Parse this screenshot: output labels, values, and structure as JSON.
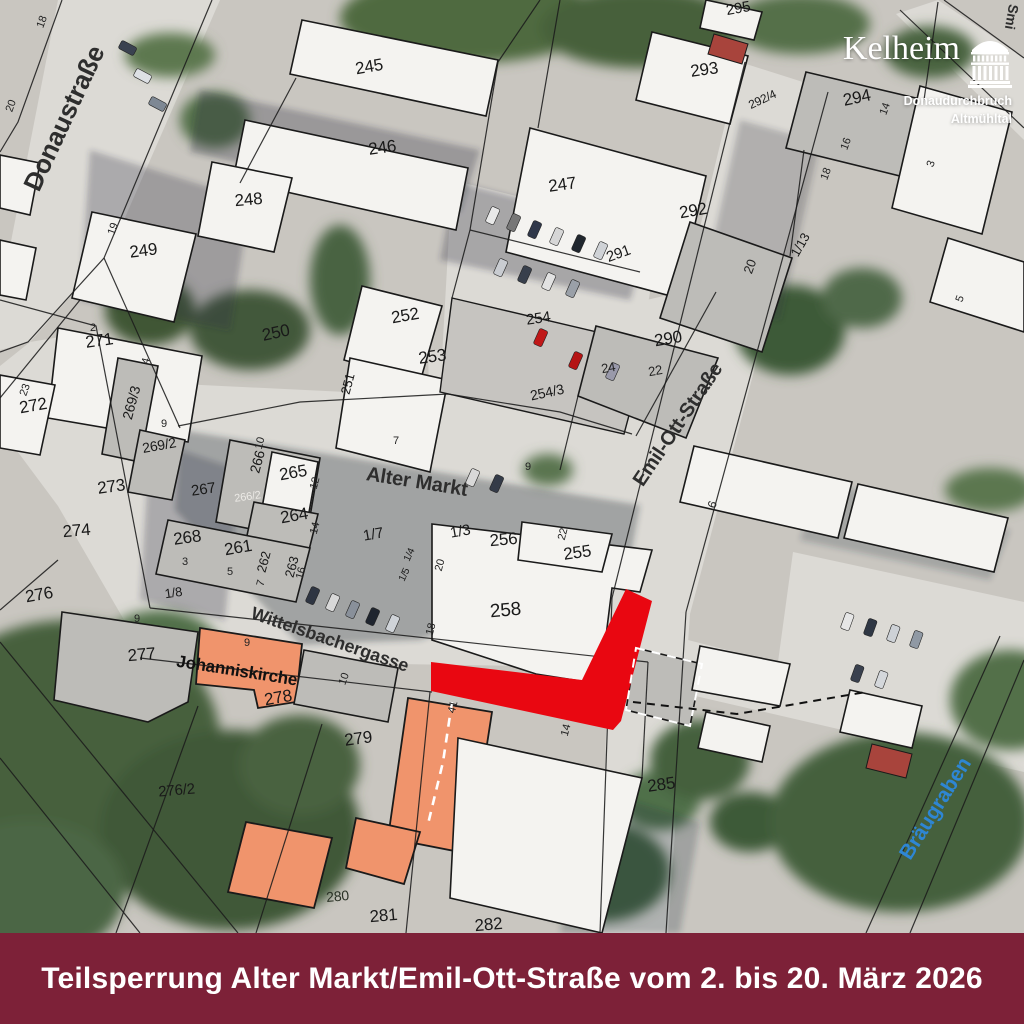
{
  "banner": {
    "text": "Teilsperrung Alter Markt/Emil-Ott-Straße vom 2. bis 20. März 2026",
    "bg_color": "#7d2138",
    "text_color": "#ffffff"
  },
  "logo": {
    "title": "Kelheim",
    "line1": "Donaudurchbruch",
    "line2": "Altmühltal",
    "icon": "befreiungshalle-monument-icon",
    "color": "#ffffff"
  },
  "map": {
    "colors": {
      "closure_red": "#e90711",
      "church_orange": "#f0946c",
      "water_blue": "#2e86d4",
      "building_white": "#f4f3f0",
      "building_gray": "#bdbcb8"
    },
    "label_groups": [
      {
        "name": "street-label",
        "fill": "#2e2e2e",
        "weight": "bold",
        "size": 19,
        "items": [
          {
            "text": "Donaustraße",
            "x": 72,
            "y": 122,
            "rot": -65,
            "size": 26
          },
          {
            "text": "Alter Markt",
            "x": 416,
            "y": 488,
            "rot": 9,
            "size": 20
          },
          {
            "text": "Emil-Ott-Straße",
            "x": 683,
            "y": 428,
            "rot": -56,
            "size": 20
          },
          {
            "text": "Wittelsbachergasse",
            "x": 328,
            "y": 645,
            "rot": 19,
            "size": 18
          },
          {
            "text": "Smi",
            "x": 1007,
            "y": 16,
            "rot": 100,
            "size": 14
          }
        ]
      },
      {
        "name": "water-label",
        "fill": "#2e86d4",
        "weight": "bold",
        "size": 21,
        "items": [
          {
            "text": "Bräugraben",
            "x": 941,
            "y": 812,
            "rot": -58
          }
        ]
      },
      {
        "name": "place-label",
        "fill": "#111111",
        "weight": "bold",
        "size": 17,
        "items": [
          {
            "text": "Johanniskirche",
            "x": 236,
            "y": 676,
            "rot": 9
          }
        ]
      },
      {
        "name": "parcel-label",
        "fill": "#191919",
        "weight": "normal",
        "size": 17,
        "items": [
          {
            "text": "245",
            "x": 370,
            "y": 72,
            "rot": -10
          },
          {
            "text": "246",
            "x": 383,
            "y": 153,
            "rot": -8
          },
          {
            "text": "247",
            "x": 563,
            "y": 190,
            "rot": -8
          },
          {
            "text": "248",
            "x": 249,
            "y": 205,
            "rot": -5
          },
          {
            "text": "249",
            "x": 144,
            "y": 256,
            "rot": -7
          },
          {
            "text": "250",
            "x": 277,
            "y": 338,
            "rot": -12
          },
          {
            "text": "251",
            "x": 352,
            "y": 385,
            "rot": -75,
            "size": 13
          },
          {
            "text": "252",
            "x": 406,
            "y": 321,
            "rot": -10
          },
          {
            "text": "253",
            "x": 433,
            "y": 362,
            "rot": -8
          },
          {
            "text": "254",
            "x": 539,
            "y": 323,
            "rot": -8,
            "size": 15
          },
          {
            "text": "254/3",
            "x": 548,
            "y": 397,
            "rot": -12,
            "size": 14
          },
          {
            "text": "255",
            "x": 578,
            "y": 558,
            "rot": -8
          },
          {
            "text": "256",
            "x": 504,
            "y": 545,
            "rot": -5
          },
          {
            "text": "258",
            "x": 506,
            "y": 616,
            "rot": -5,
            "size": 19
          },
          {
            "text": "290",
            "x": 669,
            "y": 344,
            "rot": -10
          },
          {
            "text": "291",
            "x": 620,
            "y": 258,
            "rot": -20,
            "size": 15
          },
          {
            "text": "292",
            "x": 694,
            "y": 216,
            "rot": -10
          },
          {
            "text": "292/4",
            "x": 764,
            "y": 103,
            "rot": -25,
            "size": 12
          },
          {
            "text": "293",
            "x": 705,
            "y": 75,
            "rot": -8
          },
          {
            "text": "294",
            "x": 858,
            "y": 103,
            "rot": -12
          },
          {
            "text": "295",
            "x": 739,
            "y": 13,
            "rot": -10,
            "size": 15
          },
          {
            "text": "271",
            "x": 100,
            "y": 346,
            "rot": -8
          },
          {
            "text": "272",
            "x": 34,
            "y": 411,
            "rot": -10
          },
          {
            "text": "269/3",
            "x": 136,
            "y": 404,
            "rot": -75,
            "size": 14
          },
          {
            "text": "269/2",
            "x": 160,
            "y": 450,
            "rot": -10,
            "size": 14
          },
          {
            "text": "267",
            "x": 204,
            "y": 494,
            "rot": -8,
            "size": 15
          },
          {
            "text": "266",
            "x": 262,
            "y": 463,
            "rot": -75,
            "size": 14
          },
          {
            "text": "266/2",
            "x": 248,
            "y": 500,
            "rot": -8,
            "size": 11,
            "fill": "#eceae6"
          },
          {
            "text": "265",
            "x": 294,
            "y": 478,
            "rot": -10
          },
          {
            "text": "264",
            "x": 295,
            "y": 521,
            "rot": -10
          },
          {
            "text": "268",
            "x": 188,
            "y": 543,
            "rot": -8
          },
          {
            "text": "261",
            "x": 239,
            "y": 553,
            "rot": -10
          },
          {
            "text": "262",
            "x": 268,
            "y": 563,
            "rot": -75,
            "size": 13
          },
          {
            "text": "263",
            "x": 296,
            "y": 568,
            "rot": -75,
            "size": 13
          },
          {
            "text": "273",
            "x": 112,
            "y": 492,
            "rot": -8
          },
          {
            "text": "274",
            "x": 77,
            "y": 536,
            "rot": -5
          },
          {
            "text": "276",
            "x": 40,
            "y": 600,
            "rot": -10
          },
          {
            "text": "276/2",
            "x": 177,
            "y": 795,
            "rot": -5,
            "size": 15
          },
          {
            "text": "277",
            "x": 142,
            "y": 660,
            "rot": -5
          },
          {
            "text": "278",
            "x": 279,
            "y": 703,
            "rot": -10
          },
          {
            "text": "279",
            "x": 359,
            "y": 744,
            "rot": -8
          },
          {
            "text": "280",
            "x": 338,
            "y": 901,
            "rot": -5,
            "size": 14,
            "fill": "#2a3226"
          },
          {
            "text": "281",
            "x": 384,
            "y": 921,
            "rot": -5
          },
          {
            "text": "282",
            "x": 489,
            "y": 930,
            "rot": -5
          },
          {
            "text": "285",
            "x": 662,
            "y": 790,
            "rot": -8
          },
          {
            "text": "1/7",
            "x": 374,
            "y": 539,
            "rot": -10,
            "size": 15
          },
          {
            "text": "1/3",
            "x": 461,
            "y": 536,
            "rot": -10,
            "size": 15
          },
          {
            "text": "1/8",
            "x": 174,
            "y": 597,
            "rot": -8,
            "size": 13
          },
          {
            "text": "1/13",
            "x": 804,
            "y": 247,
            "rot": -60,
            "size": 13
          },
          {
            "text": "1/5",
            "x": 407,
            "y": 576,
            "rot": -65,
            "size": 10
          },
          {
            "text": "1/4",
            "x": 412,
            "y": 556,
            "rot": -65,
            "size": 10
          }
        ]
      },
      {
        "name": "house-number",
        "fill": "#232323",
        "weight": "normal",
        "size": 11,
        "items": [
          {
            "text": "2",
            "x": 93,
            "y": 331,
            "rot": 0
          },
          {
            "text": "23",
            "x": 28,
            "y": 391,
            "rot": -70
          },
          {
            "text": "4",
            "x": 149,
            "y": 362,
            "rot": -75
          },
          {
            "text": "9",
            "x": 164,
            "y": 427,
            "rot": 0
          },
          {
            "text": "10",
            "x": 263,
            "y": 444,
            "rot": -75
          },
          {
            "text": "12",
            "x": 318,
            "y": 484,
            "rot": -75
          },
          {
            "text": "14",
            "x": 318,
            "y": 529,
            "rot": -75
          },
          {
            "text": "3",
            "x": 185,
            "y": 565,
            "rot": 0
          },
          {
            "text": "5",
            "x": 230,
            "y": 575,
            "rot": 0
          },
          {
            "text": "7",
            "x": 264,
            "y": 584,
            "rot": -75
          },
          {
            "text": "16",
            "x": 304,
            "y": 574,
            "rot": -75
          },
          {
            "text": "9",
            "x": 137,
            "y": 622,
            "rot": 0
          },
          {
            "text": "9",
            "x": 247,
            "y": 646,
            "rot": 0
          },
          {
            "text": "10",
            "x": 347,
            "y": 680,
            "rot": -70
          },
          {
            "text": "41",
            "x": 456,
            "y": 708,
            "rot": -75
          },
          {
            "text": "14",
            "x": 569,
            "y": 731,
            "rot": -75
          },
          {
            "text": "18",
            "x": 434,
            "y": 630,
            "rot": -75
          },
          {
            "text": "20",
            "x": 443,
            "y": 566,
            "rot": -75
          },
          {
            "text": "22",
            "x": 566,
            "y": 535,
            "rot": -75
          },
          {
            "text": "9",
            "x": 528,
            "y": 470,
            "rot": 0
          },
          {
            "text": "7",
            "x": 396,
            "y": 444,
            "rot": 0
          },
          {
            "text": "24",
            "x": 609,
            "y": 372,
            "rot": -10,
            "size": 13
          },
          {
            "text": "22",
            "x": 656,
            "y": 375,
            "rot": -10,
            "size": 13
          },
          {
            "text": "20",
            "x": 754,
            "y": 268,
            "rot": -70,
            "size": 13
          },
          {
            "text": "6",
            "x": 716,
            "y": 506,
            "rot": -70,
            "size": 12
          },
          {
            "text": "19",
            "x": 116,
            "y": 230,
            "rot": -70
          },
          {
            "text": "18",
            "x": 45,
            "y": 23,
            "rot": -70
          },
          {
            "text": "20",
            "x": 14,
            "y": 107,
            "rot": -70
          },
          {
            "text": "3",
            "x": 934,
            "y": 165,
            "rot": -70
          },
          {
            "text": "14",
            "x": 888,
            "y": 110,
            "rot": -70
          },
          {
            "text": "16",
            "x": 849,
            "y": 145,
            "rot": -70
          },
          {
            "text": "18",
            "x": 829,
            "y": 175,
            "rot": -70
          },
          {
            "text": "5",
            "x": 963,
            "y": 300,
            "rot": -70
          }
        ]
      }
    ]
  }
}
